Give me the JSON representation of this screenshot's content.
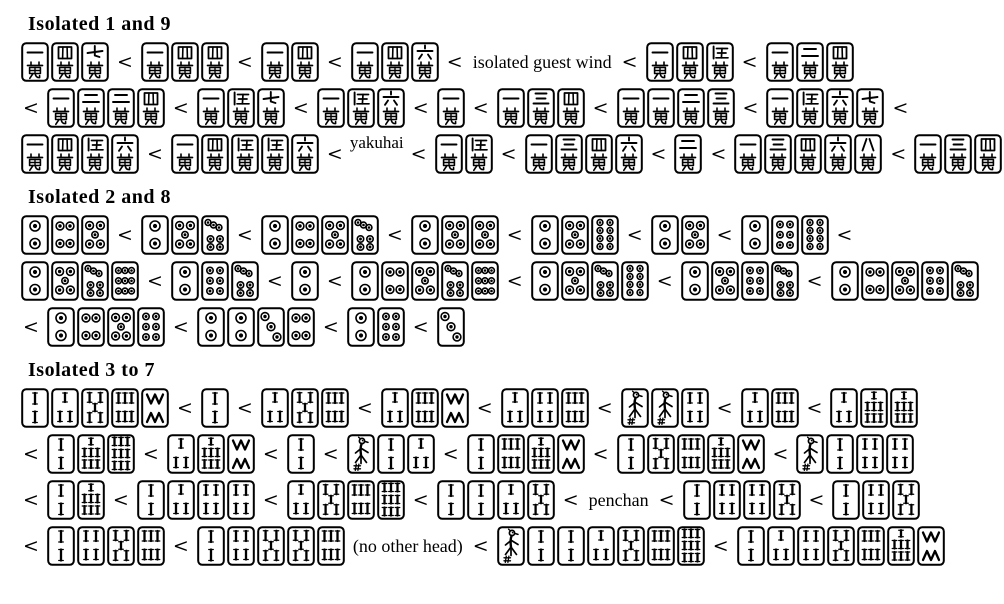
{
  "page": {
    "background": "#ffffff",
    "ink": "#000000",
    "tile_fill": "#ffffff",
    "separator": "<"
  },
  "sections": [
    {
      "title": "Isolated 1 and 9",
      "rows": [
        {
          "items": [
            {
              "t": "tiles",
              "v": [
                "1m",
                "4m",
                "7m"
              ]
            },
            {
              "t": "lt"
            },
            {
              "t": "tiles",
              "v": [
                "1m",
                "4m",
                "4m"
              ]
            },
            {
              "t": "lt"
            },
            {
              "t": "tiles",
              "v": [
                "1m",
                "4m"
              ]
            },
            {
              "t": "lt"
            },
            {
              "t": "tiles",
              "v": [
                "1m",
                "4m",
                "6m"
              ]
            },
            {
              "t": "lt"
            },
            {
              "t": "txt",
              "v": "isolated guest wind"
            },
            {
              "t": "lt"
            },
            {
              "t": "tiles",
              "v": [
                "1m",
                "4m",
                "5m"
              ]
            },
            {
              "t": "lt"
            },
            {
              "t": "tiles",
              "v": [
                "1m",
                "2m",
                "4m"
              ]
            }
          ]
        },
        {
          "items": [
            {
              "t": "lt"
            },
            {
              "t": "tiles",
              "v": [
                "1m",
                "2m",
                "2m",
                "4m"
              ]
            },
            {
              "t": "lt"
            },
            {
              "t": "tiles",
              "v": [
                "1m",
                "5m",
                "7m"
              ]
            },
            {
              "t": "lt"
            },
            {
              "t": "tiles",
              "v": [
                "1m",
                "5m",
                "6m"
              ]
            },
            {
              "t": "lt"
            },
            {
              "t": "tiles",
              "v": [
                "1m"
              ]
            },
            {
              "t": "lt"
            },
            {
              "t": "tiles",
              "v": [
                "1m",
                "3m",
                "4m"
              ]
            },
            {
              "t": "lt"
            },
            {
              "t": "tiles",
              "v": [
                "1m",
                "1m",
                "2m",
                "3m"
              ]
            },
            {
              "t": "lt"
            },
            {
              "t": "tiles",
              "v": [
                "1m",
                "5m",
                "6m",
                "7m"
              ]
            },
            {
              "t": "lt"
            }
          ]
        },
        {
          "items": [
            {
              "t": "tiles",
              "v": [
                "1m",
                "4m",
                "5m",
                "6m"
              ]
            },
            {
              "t": "lt"
            },
            {
              "t": "tiles",
              "v": [
                "1m",
                "4m",
                "5m",
                "5m",
                "6m"
              ]
            },
            {
              "t": "lt"
            },
            {
              "t": "txt",
              "v": "yakuhai",
              "raised": true
            },
            {
              "t": "lt"
            },
            {
              "t": "tiles",
              "v": [
                "1m",
                "5m"
              ]
            },
            {
              "t": "lt"
            },
            {
              "t": "tiles",
              "v": [
                "1m",
                "3m",
                "4m",
                "6m"
              ]
            },
            {
              "t": "lt"
            },
            {
              "t": "tiles",
              "v": [
                "2m"
              ]
            },
            {
              "t": "lt"
            },
            {
              "t": "tiles",
              "v": [
                "1m",
                "3m",
                "4m",
                "6m",
                "8m"
              ]
            },
            {
              "t": "lt"
            },
            {
              "t": "tiles",
              "v": [
                "1m",
                "3m",
                "4m",
                "5m"
              ]
            }
          ]
        }
      ]
    },
    {
      "title": "Isolated 2 and 8",
      "rows": [
        {
          "items": [
            {
              "t": "tiles",
              "v": [
                "2p",
                "4p",
                "5p"
              ]
            },
            {
              "t": "lt"
            },
            {
              "t": "tiles",
              "v": [
                "2p",
                "5p",
                "7p"
              ]
            },
            {
              "t": "lt"
            },
            {
              "t": "tiles",
              "v": [
                "2p",
                "4p",
                "5p",
                "7p"
              ]
            },
            {
              "t": "lt"
            },
            {
              "t": "tiles",
              "v": [
                "2p",
                "5p",
                "5p"
              ]
            },
            {
              "t": "lt"
            },
            {
              "t": "tiles",
              "v": [
                "2p",
                "5p",
                "8p"
              ]
            },
            {
              "t": "lt"
            },
            {
              "t": "tiles",
              "v": [
                "2p",
                "5p"
              ]
            },
            {
              "t": "lt"
            },
            {
              "t": "tiles",
              "v": [
                "2p",
                "6p",
                "8p"
              ]
            },
            {
              "t": "lt"
            }
          ]
        },
        {
          "items": [
            {
              "t": "tiles",
              "v": [
                "2p",
                "5p",
                "7p",
                "9p"
              ]
            },
            {
              "t": "lt"
            },
            {
              "t": "tiles",
              "v": [
                "2p",
                "6p",
                "7p"
              ]
            },
            {
              "t": "lt"
            },
            {
              "t": "tiles",
              "v": [
                "2p"
              ]
            },
            {
              "t": "lt"
            },
            {
              "t": "tiles",
              "v": [
                "2p",
                "4p",
                "5p",
                "7p",
                "9p"
              ]
            },
            {
              "t": "lt"
            },
            {
              "t": "tiles",
              "v": [
                "2p",
                "5p",
                "7p",
                "8p"
              ]
            },
            {
              "t": "lt"
            },
            {
              "t": "tiles",
              "v": [
                "2p",
                "5p",
                "6p",
                "7p"
              ]
            },
            {
              "t": "lt"
            },
            {
              "t": "tiles",
              "v": [
                "2p",
                "4p",
                "5p",
                "6p",
                "7p"
              ]
            }
          ]
        },
        {
          "items": [
            {
              "t": "lt"
            },
            {
              "t": "tiles",
              "v": [
                "2p",
                "4p",
                "5p",
                "6p"
              ]
            },
            {
              "t": "lt"
            },
            {
              "t": "tiles",
              "v": [
                "2p",
                "2p",
                "3p",
                "4p"
              ]
            },
            {
              "t": "lt"
            },
            {
              "t": "tiles",
              "v": [
                "2p",
                "6p"
              ]
            },
            {
              "t": "lt"
            },
            {
              "t": "tiles",
              "v": [
                "3p"
              ]
            }
          ]
        }
      ]
    },
    {
      "title": "Isolated 3 to 7",
      "rows": [
        {
          "items": [
            {
              "t": "tiles",
              "v": [
                "2s",
                "3s",
                "5s",
                "6s",
                "8s"
              ]
            },
            {
              "t": "lt"
            },
            {
              "t": "tiles",
              "v": [
                "2s"
              ]
            },
            {
              "t": "lt"
            },
            {
              "t": "tiles",
              "v": [
                "3s",
                "5s",
                "6s"
              ]
            },
            {
              "t": "lt"
            },
            {
              "t": "tiles",
              "v": [
                "3s",
                "6s",
                "8s"
              ]
            },
            {
              "t": "lt"
            },
            {
              "t": "tiles",
              "v": [
                "3s",
                "4s",
                "6s"
              ]
            },
            {
              "t": "lt"
            },
            {
              "t": "tiles",
              "v": [
                "1s",
                "1s",
                "4s"
              ]
            },
            {
              "t": "lt"
            },
            {
              "t": "tiles",
              "v": [
                "3s",
                "6s"
              ]
            },
            {
              "t": "lt"
            },
            {
              "t": "tiles",
              "v": [
                "3s",
                "7s",
                "7s"
              ]
            }
          ]
        },
        {
          "items": [
            {
              "t": "lt"
            },
            {
              "t": "tiles",
              "v": [
                "2s",
                "7s",
                "9s"
              ]
            },
            {
              "t": "lt"
            },
            {
              "t": "tiles",
              "v": [
                "3s",
                "7s",
                "8s"
              ]
            },
            {
              "t": "lt"
            },
            {
              "t": "tiles",
              "v": [
                "2s"
              ]
            },
            {
              "t": "lt"
            },
            {
              "t": "tiles",
              "v": [
                "1s",
                "2s",
                "3s"
              ]
            },
            {
              "t": "lt"
            },
            {
              "t": "tiles",
              "v": [
                "2s",
                "6s",
                "7s",
                "8s"
              ]
            },
            {
              "t": "lt"
            },
            {
              "t": "tiles",
              "v": [
                "2s",
                "5s",
                "6s",
                "7s",
                "8s"
              ]
            },
            {
              "t": "lt"
            },
            {
              "t": "tiles",
              "v": [
                "1s",
                "2s",
                "4s",
                "4s"
              ]
            }
          ]
        },
        {
          "items": [
            {
              "t": "lt"
            },
            {
              "t": "tiles",
              "v": [
                "2s",
                "7s"
              ]
            },
            {
              "t": "lt"
            },
            {
              "t": "tiles",
              "v": [
                "2s",
                "3s",
                "4s",
                "4s"
              ]
            },
            {
              "t": "lt"
            },
            {
              "t": "tiles",
              "v": [
                "3s",
                "5s",
                "6s",
                "9s"
              ]
            },
            {
              "t": "lt"
            },
            {
              "t": "tiles",
              "v": [
                "2s",
                "2s",
                "3s",
                "5s"
              ]
            },
            {
              "t": "lt"
            },
            {
              "t": "txt",
              "v": "penchan"
            },
            {
              "t": "lt"
            },
            {
              "t": "tiles",
              "v": [
                "2s",
                "4s",
                "4s",
                "5s"
              ]
            },
            {
              "t": "lt"
            },
            {
              "t": "tiles",
              "v": [
                "2s",
                "4s",
                "5s"
              ]
            }
          ]
        },
        {
          "items": [
            {
              "t": "lt"
            },
            {
              "t": "tiles",
              "v": [
                "2s",
                "4s",
                "5s",
                "6s"
              ]
            },
            {
              "t": "lt"
            },
            {
              "t": "tiles",
              "v": [
                "2s",
                "4s",
                "5s",
                "5s",
                "6s"
              ]
            },
            {
              "t": "txt",
              "v": "(no other head)"
            },
            {
              "t": "lt"
            },
            {
              "t": "tiles",
              "v": [
                "1s",
                "2s",
                "2s",
                "3s",
                "5s",
                "6s",
                "9s"
              ]
            },
            {
              "t": "lt"
            },
            {
              "t": "tiles",
              "v": [
                "2s",
                "3s",
                "4s",
                "5s",
                "6s",
                "7s",
                "8s"
              ]
            }
          ]
        }
      ]
    }
  ]
}
